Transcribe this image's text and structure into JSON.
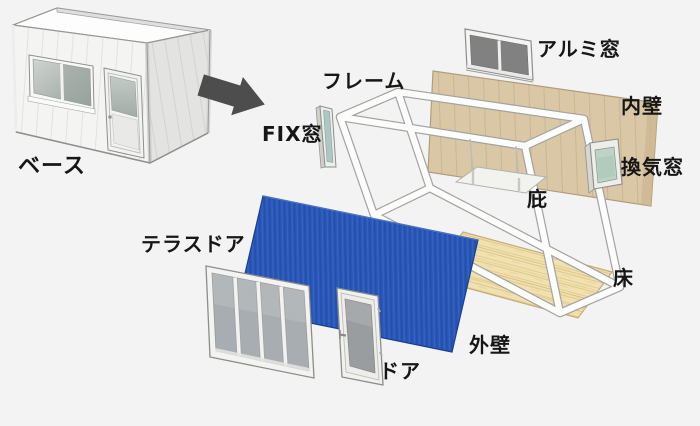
{
  "diagram": {
    "type": "exploded-assembly-of-prefab-unit-house",
    "labels": {
      "base": "ベース",
      "frame": "フレーム",
      "fix_window": "FIX窓",
      "aluminum_window": "アルミ窓",
      "inner_wall": "内壁",
      "vent_window": "換気窓",
      "canopy": "庇",
      "floor": "床",
      "terrace_door": "テラスドア",
      "door": "ドア",
      "outer_wall": "外壁"
    },
    "colors": {
      "background": "#f3f3f4",
      "outer_wall_blue": "#2a57ba",
      "inner_wall_tan": "#d9c7a6",
      "floor_wood": "#f1e1b0",
      "frame_white": "#fcfcfb",
      "window_glass_dark": "#818181",
      "vent_glass_green": "#bcd3c6",
      "arrow_gray": "#4d4d4d",
      "label_text": "#161616"
    }
  }
}
